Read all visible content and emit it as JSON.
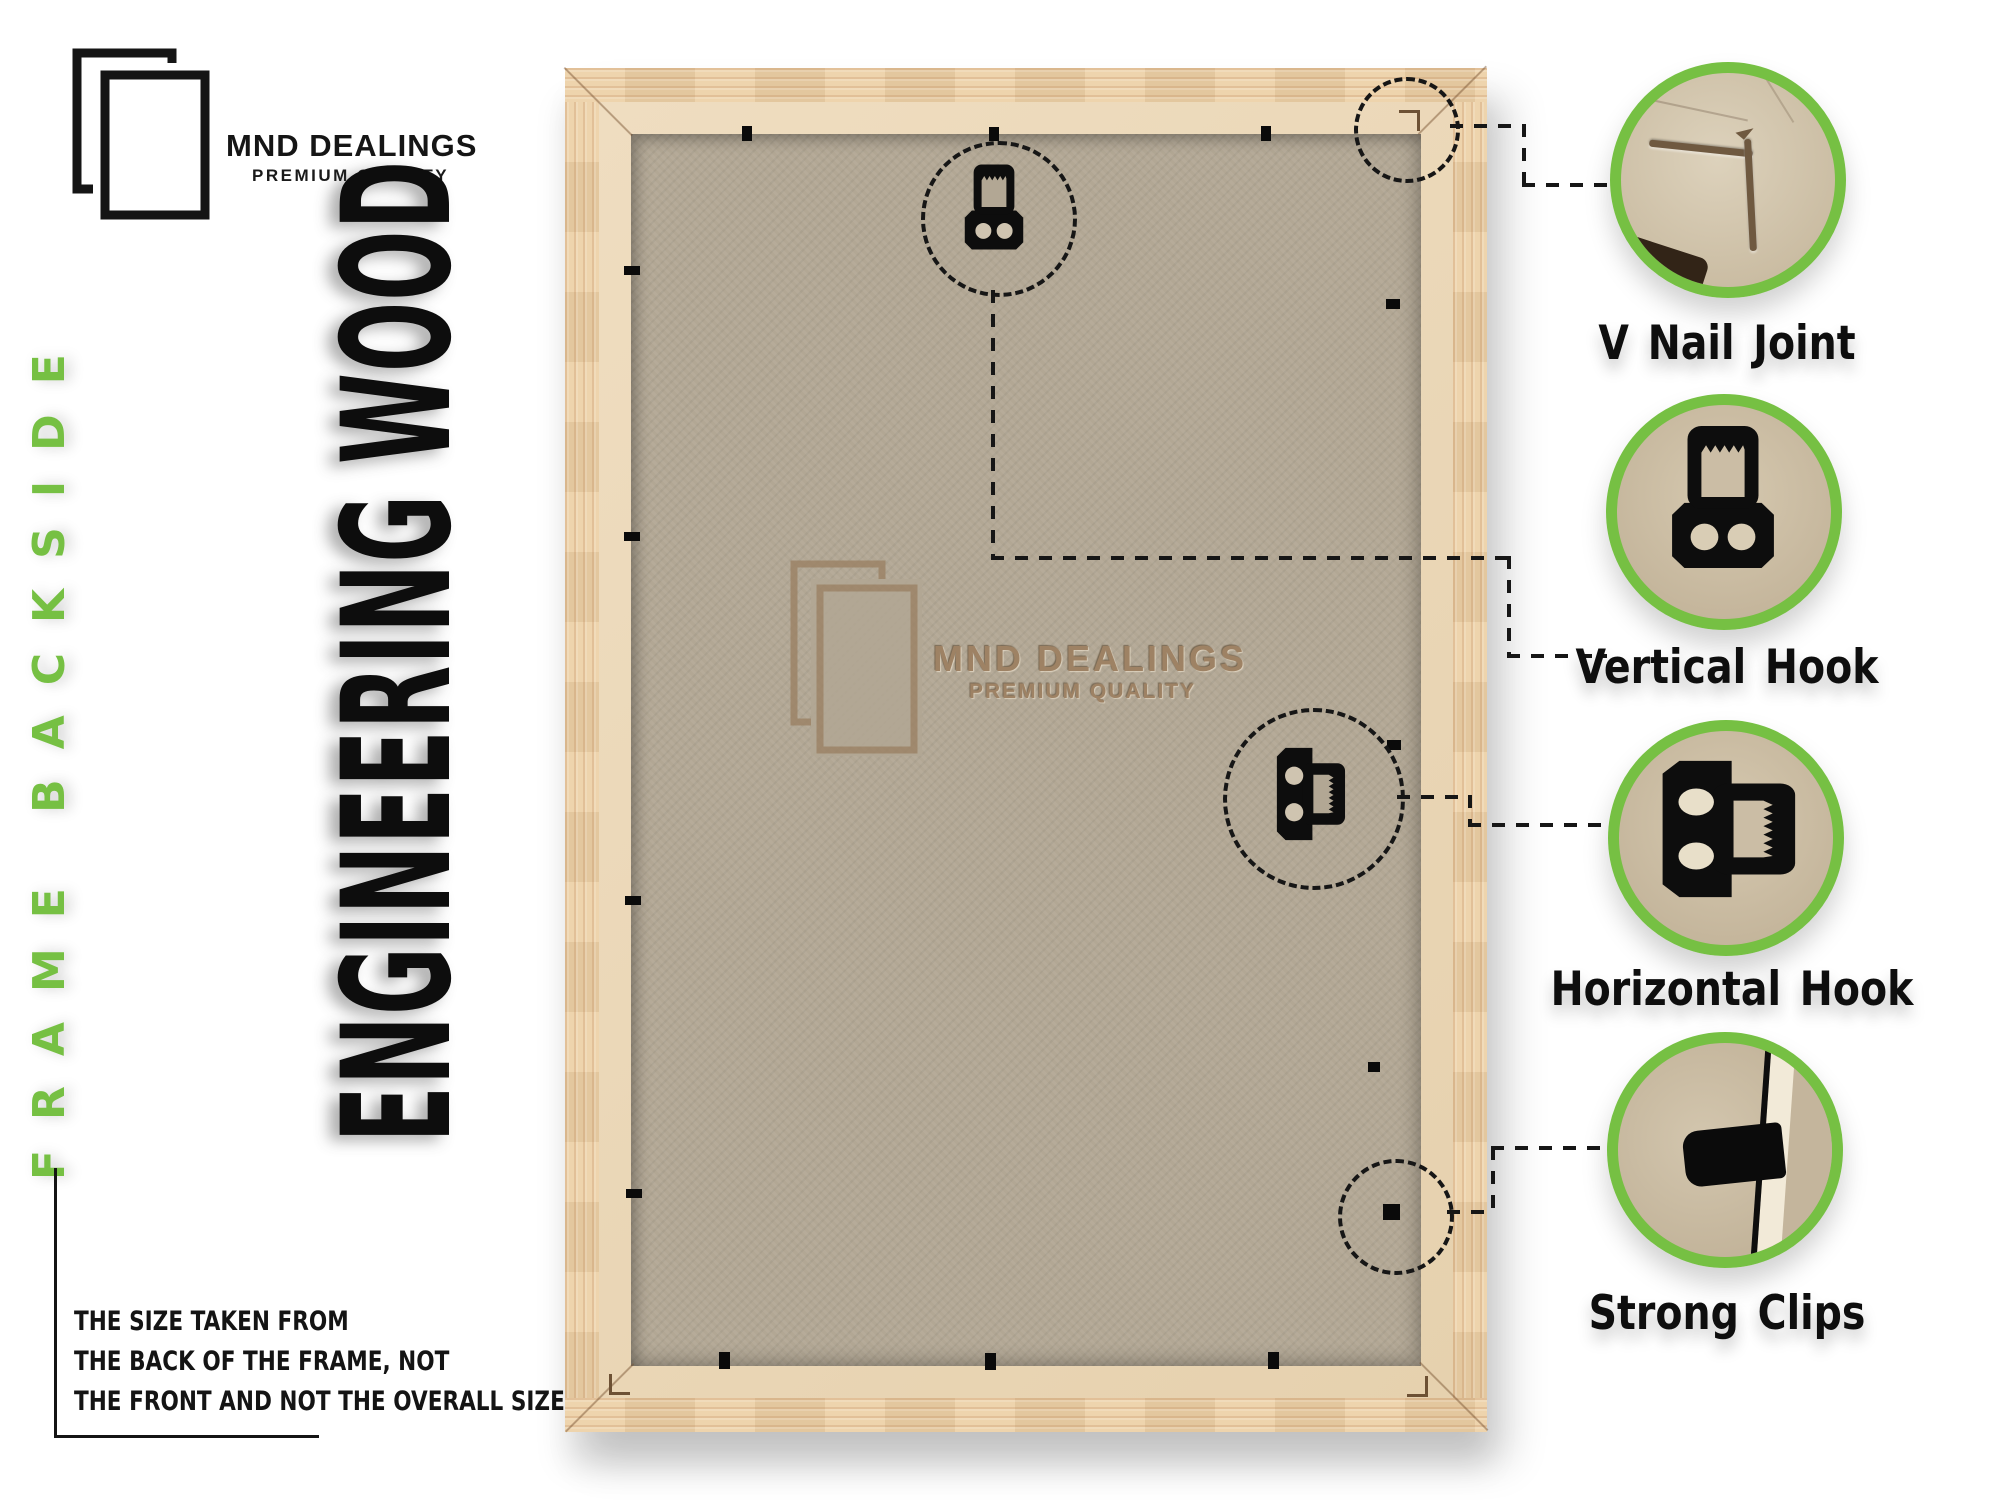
{
  "brand": {
    "name": "MND DEALINGS",
    "tagline": "PREMIUM QUALITY"
  },
  "left_rail": {
    "side_label": "FRAME BACKSIDE"
  },
  "headline": {
    "material_label": "ENGINEERING WOOD"
  },
  "frame": {
    "watermark": {
      "name": "MND DEALINGS",
      "tagline": "PREMIUM QUALITY"
    }
  },
  "note": {
    "lines": [
      "THE SIZE TAKEN FROM",
      "THE BACK OF THE FRAME, NOT",
      "THE FRONT AND NOT THE OVERALL SIZE."
    ]
  },
  "callouts": [
    {
      "id": "v-nail-joint",
      "label": "V Nail Joint"
    },
    {
      "id": "vertical-hook",
      "label": "Vertical Hook"
    },
    {
      "id": "horizontal-hook",
      "label": "Horizontal Hook"
    },
    {
      "id": "strong-clips",
      "label": "Strong Clips"
    }
  ],
  "colors": {
    "accent_green": "#76c043",
    "wood_border": "#eccfa4",
    "wood_lip": "#e9d6b8",
    "mdf_board": "#b2a794",
    "emboss": "#9e8264",
    "ink": "#111111"
  }
}
